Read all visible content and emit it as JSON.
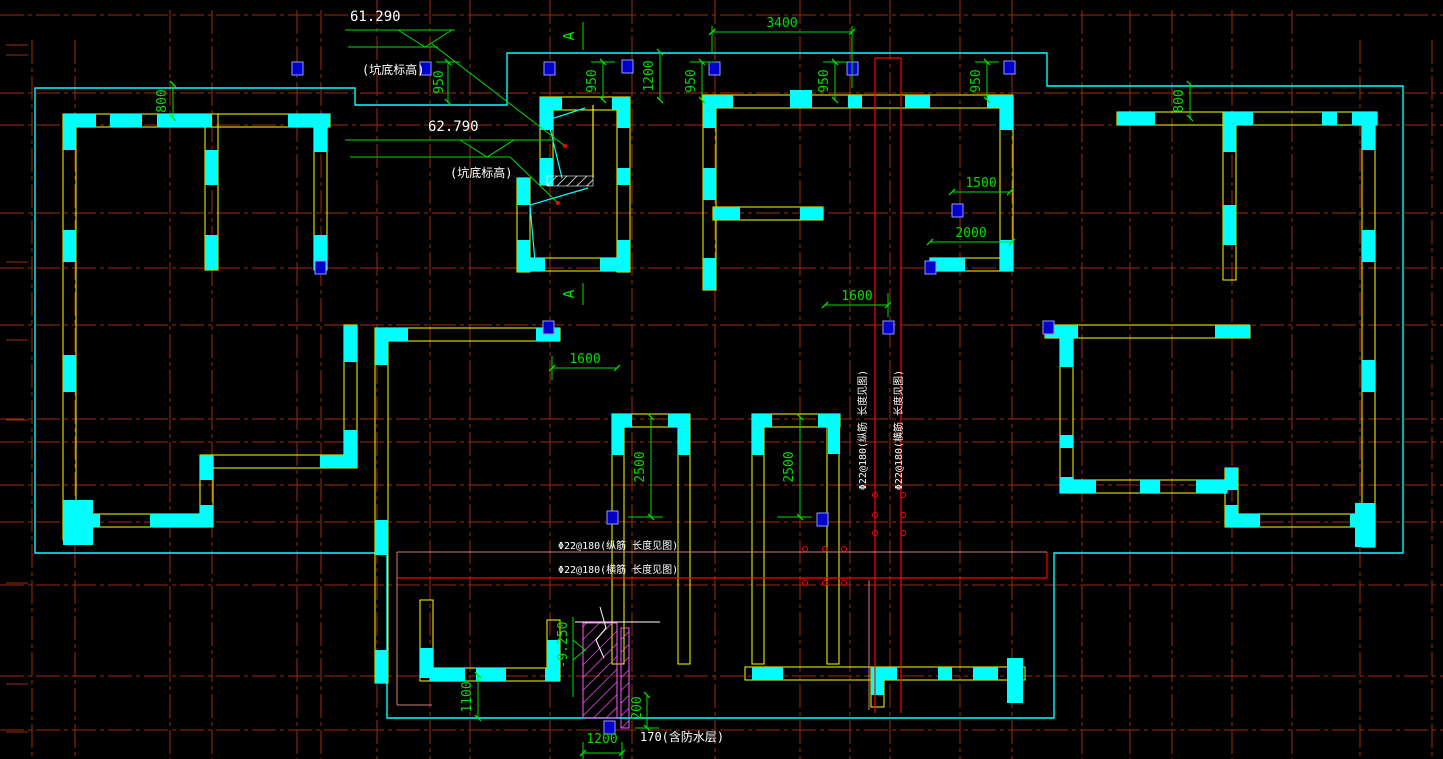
{
  "drawing": {
    "title": "foundation-raft-plan",
    "elevation_marks": {
      "e1": "61.290",
      "e2": "62.790",
      "pit_label": "(坑底标高)",
      "neg": "-9.250"
    },
    "dims": {
      "d3400": "3400",
      "d950": "950",
      "d1200": "1200",
      "d800": "800",
      "d1500": "1500",
      "d2000": "2000",
      "d1600": "1600",
      "d2500": "2500",
      "d1100": "1100",
      "d200": "200",
      "d1200b": "1200"
    },
    "notes": {
      "rebar_h1": "Φ22@180(纵筋 长度见图)",
      "rebar_h2": "Φ22@180(横筋 长度见图)",
      "rebar_v1": "Φ22@180(纵筋 长度见图)",
      "rebar_v2": "Φ22@180(横筋 长度见图)",
      "waterproof": "170(含防水层)"
    },
    "section": {
      "label": "A"
    },
    "colors": {
      "grid": "#9e2b0e",
      "bright_red": "#ff0000",
      "wall_cyan": "#00ffff",
      "wall_yellow": "#ffff00",
      "dim_green": "#00dd00",
      "pier_magenta": "#ff55ff",
      "blue_marker": "#0000cc",
      "pink": "#cc8080"
    }
  }
}
